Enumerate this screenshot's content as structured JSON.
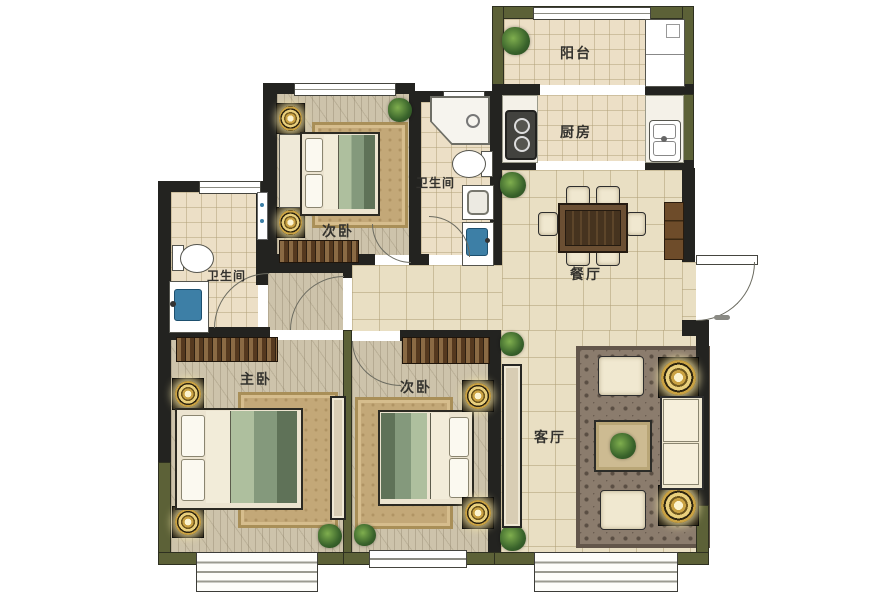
{
  "rooms": {
    "balcony": {
      "label": "阳台"
    },
    "kitchen": {
      "label": "厨房"
    },
    "bathroom_upper": {
      "label": "卫生间"
    },
    "bathroom_lower": {
      "label": "卫生间"
    },
    "bedroom_upper": {
      "label": "次卧"
    },
    "bedroom_lower": {
      "label": "次卧"
    },
    "master_bedroom": {
      "label": "主卧"
    },
    "dining_room": {
      "label": "餐厅"
    },
    "living_room": {
      "label": "客厅"
    }
  },
  "palette": {
    "wall_dark": "#232320",
    "wall_olive": "#5c6137",
    "floor_tile": "#e9dfc3",
    "floor_wood": "#cdc3ab",
    "rug_tan": "#c3a878",
    "rug_dark": "#8b7c6d",
    "lamp_gold": "#e9cf7c",
    "plant_green": "#39632b",
    "sink_blue": "#3d7fa6"
  }
}
